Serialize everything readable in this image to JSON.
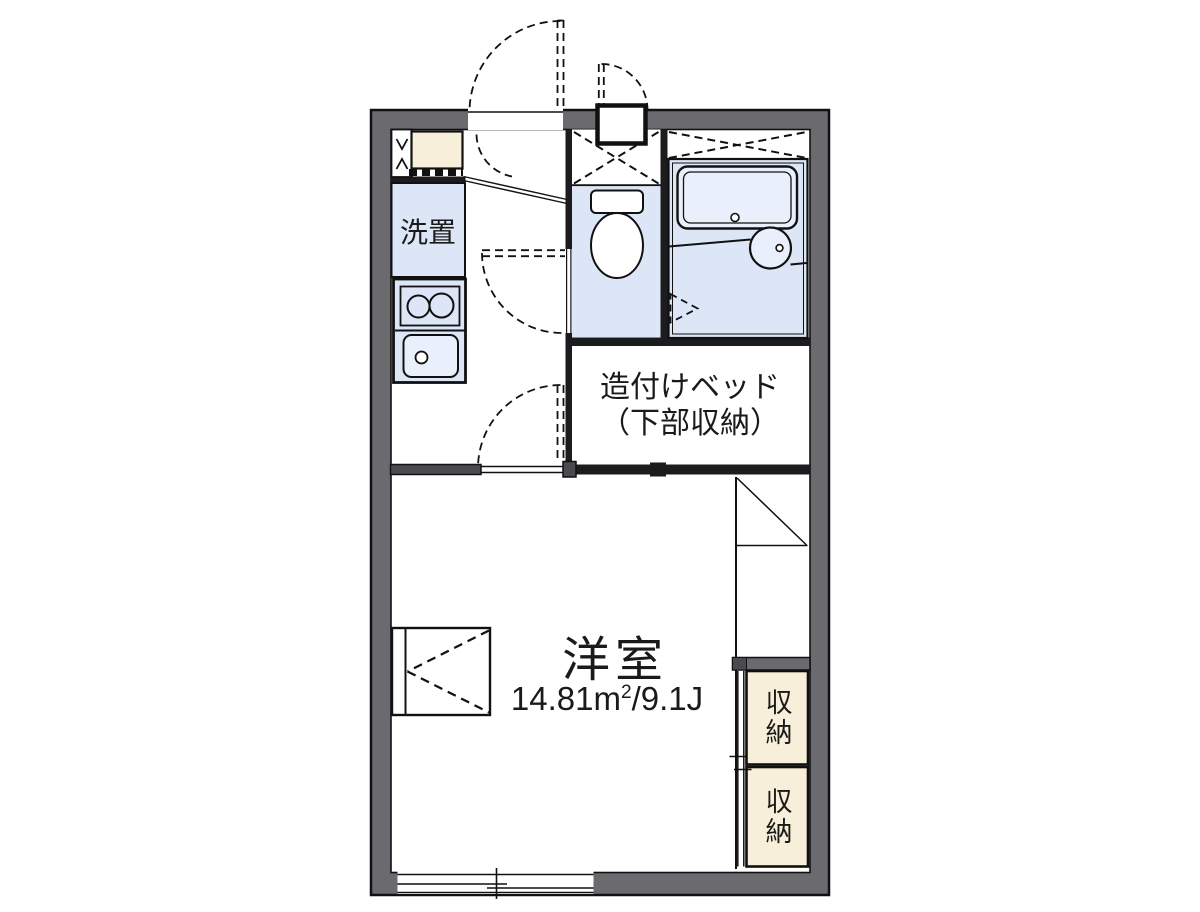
{
  "plan": {
    "title": "apartment-floor-plan",
    "labels": {
      "washer": "洗置",
      "bed_line1": "造付けベッド",
      "bed_line2": "（下部収納）",
      "room_name": "洋室",
      "area_value": "14.81",
      "area_unit_base": "m",
      "area_unit_sup": "2",
      "area_tail": "/9.1J",
      "closet_upper": "収納",
      "closet_lower": "収納"
    },
    "colors": {
      "outer_wall_gray": "#6b6b6f",
      "inner_wall_dark": "#4b4b4f",
      "partition_black": "#1c1c1e",
      "room_blue": "#dce6f6",
      "fixture_blue": "#eaf0fb",
      "closet_cream": "#f8efda",
      "line_black": "#111111",
      "background": "#ffffff"
    }
  }
}
